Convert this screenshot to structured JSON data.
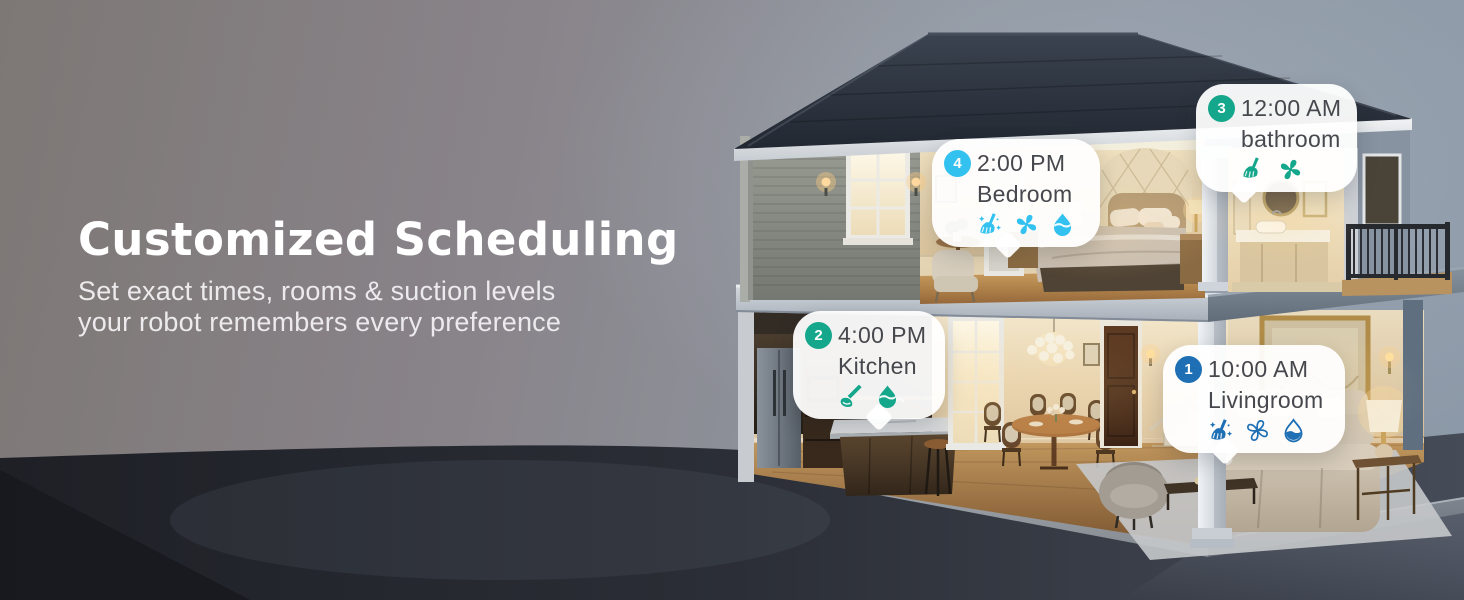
{
  "hero": {
    "title": "Customized Scheduling",
    "subtitle_line1": "Set exact times, rooms & suction levels",
    "subtitle_line2": "your robot remembers every preference"
  },
  "schedule": {
    "bubbles": [
      {
        "id": "livingroom",
        "number": "1",
        "time": "10:00 AM",
        "room": "Livingroom",
        "accent": "#1E6FB4",
        "icons": [
          "broom-sparkle",
          "fan-outline",
          "drop-outline"
        ]
      },
      {
        "id": "kitchen",
        "number": "2",
        "time": "4:00 PM",
        "room": "Kitchen",
        "accent": "#15A78C",
        "icons": [
          "mop",
          "drop"
        ]
      },
      {
        "id": "bathroom",
        "number": "3",
        "time": "12:00 AM",
        "room": "bathroom",
        "accent": "#15A78C",
        "icons": [
          "broom",
          "fan"
        ]
      },
      {
        "id": "bedroom",
        "number": "4",
        "time": "2:00 PM",
        "room": "Bedroom",
        "accent": "#33C1F0",
        "icons": [
          "broom-sparkle",
          "fan",
          "drop"
        ]
      }
    ]
  },
  "colors": {
    "teal": "#15A78C",
    "cyan": "#33C1F0",
    "blue": "#1E6FB4",
    "bubble_text": "#46484D",
    "headline": "#FFFFFF"
  }
}
